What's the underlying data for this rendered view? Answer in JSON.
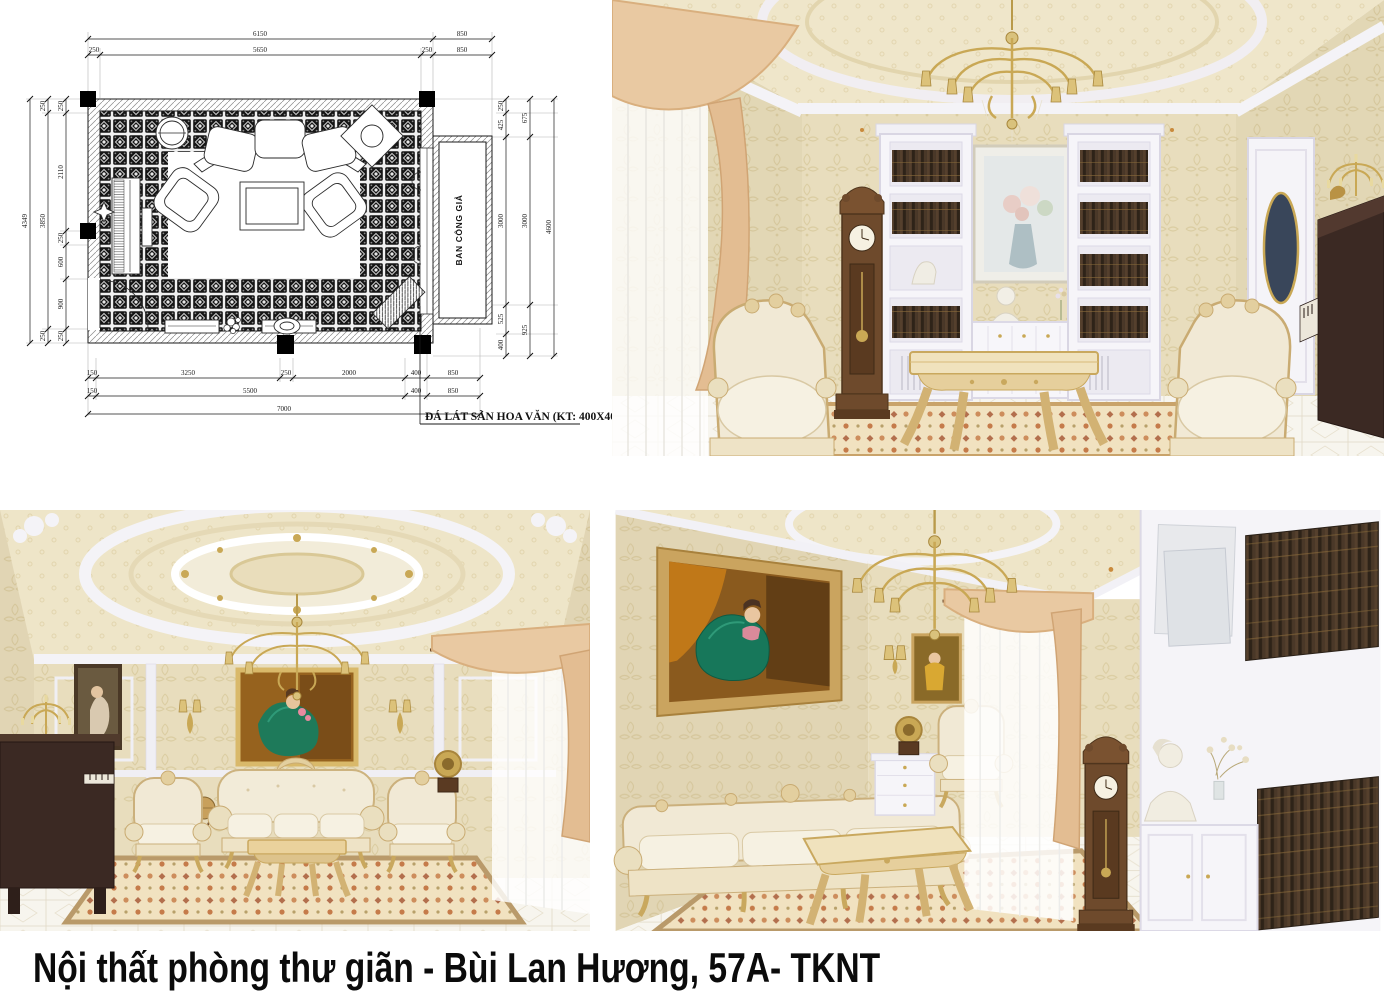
{
  "page": {
    "caption": "Nội thất phòng thư giãn - Bùi Lan Hương, 57A- TKNT"
  },
  "floor_plan": {
    "balcony_label": "BAN CÔNG GIẢ",
    "floor_note": "ĐÁ LÁT SÀN HOA VĂN (KT: 400X400)",
    "dims": {
      "top_row1": [
        "6150",
        "850"
      ],
      "top_row2": [
        "250",
        "5650",
        "250",
        "850"
      ],
      "left_outer": "4349",
      "left_mid": [
        "250",
        "3850",
        "250"
      ],
      "left_inner": [
        "250",
        "2110",
        "250",
        "600",
        "900",
        "250"
      ],
      "right_inner": [
        "250",
        "425",
        "3000",
        "525",
        "400"
      ],
      "right_mid": [
        "675",
        "3000",
        "925"
      ],
      "right_outer": "4600",
      "bottom_row1": [
        "150",
        "3250",
        "250",
        "2000",
        "400",
        "850"
      ],
      "bottom_row2": [
        "150",
        "5500",
        "400",
        "850"
      ],
      "bottom_row3": [
        "7000"
      ]
    }
  },
  "palette": {
    "wall_beige": "#e8ddbd",
    "ceiling_cream": "#efe6ca",
    "molding_white": "#f4f3f7",
    "curtain_peach": "#e9c9a2",
    "gold": "#c9a855",
    "cream_furniture": "#f1e9d5",
    "piano_brown": "#3b2923",
    "clock_brown": "#6e4a2c",
    "rug_cream": "#f1e2c0",
    "rug_accent": "#c57b4a",
    "painting_green": "#1e7a5a"
  }
}
